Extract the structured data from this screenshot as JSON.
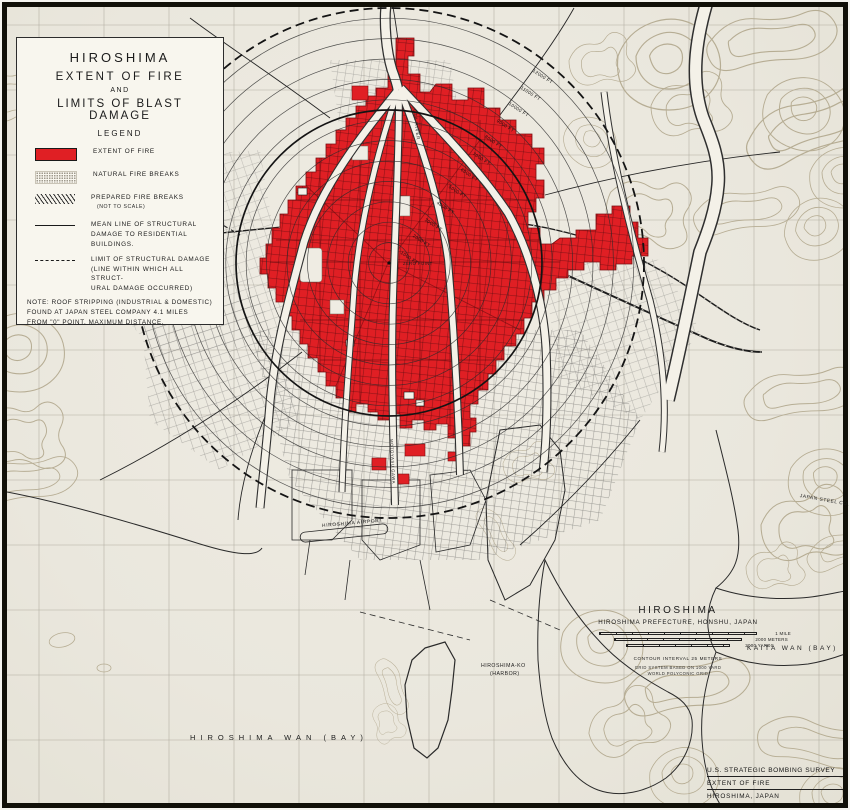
{
  "map_title": "Hiroshima — Extent of Fire and Limits of Blast Damage",
  "colors": {
    "fire_red": "#e01f24",
    "paper": "#eae7dd",
    "ink": "#1d1d1d",
    "contour_tan": "#b4aa90"
  },
  "legend": {
    "title_line1": "HIROSHIMA",
    "title_line2": "EXTENT OF FIRE",
    "title_line3": "AND",
    "title_line4": "LIMITS OF BLAST DAMAGE",
    "heading": "LEGEND",
    "items": [
      {
        "label": "EXTENT OF FIRE"
      },
      {
        "label": "NATURAL FIRE BREAKS"
      },
      {
        "label": "PREPARED FIRE BREAKS",
        "note": "(NOT TO SCALE)"
      },
      {
        "line1": "MEAN LINE OF STRUCTURAL",
        "line2": "DAMAGE TO RESIDENTIAL BUILDINGS."
      },
      {
        "line1": "LIMIT OF STRUCTURAL DAMAGE",
        "line2": "(LINE WITHIN WHICH ALL STRUCT-",
        "line3": "URAL DAMAGE OCCURRED)"
      }
    ],
    "note_line1": "NOTE: ROOF STRIPPING (INDUSTRIAL & DOMESTIC)",
    "note_line2": "FOUND AT JAPAN STEEL COMPANY 4.1 MILES",
    "note_line3": "FROM \"0\" POINT. MAXIMUM DISTANCE."
  },
  "rings": {
    "zero_label": "ZERO POINT",
    "labels": [
      "1000 FT",
      "2000 FT",
      "3000 FT",
      "4000 FT",
      "5000 FT",
      "6000 FT",
      "7000 FT",
      "8000 FT",
      "9000 FT",
      "10000 FT",
      "11000 FT",
      "12000 FT"
    ]
  },
  "labels": {
    "hiroshima_wan": "HIROSHIMA WAN (BAY)",
    "kaita_wan": "KAITA WAN (BAY)",
    "harbor_line1": "HIROSHIMA-KO",
    "harbor_line2": "(HARBOR)",
    "airport": "HIROSHIMA AIRPORT",
    "japan_steel": "JAPAN STEEL CO.",
    "ota_river": "OTA RIVER",
    "motoyasu_gawa": "MOTOYASU GAWA"
  },
  "title_block": {
    "title": "HIROSHIMA",
    "subtitle": "HIROSHIMA PREFECTURE, HONSHU, JAPAN",
    "scale_mile": "1 MILE",
    "scale_meters": "2000 METERS",
    "scale_yards": "2000 YARDS",
    "contour_note": "CONTOUR INTERVAL 25 METERS",
    "grid_note_line1": "GRID SYSTEM BASED ON 1000 YARD",
    "grid_note_line2": "WORLD POLYCONIC GRID"
  },
  "credit": {
    "line1": "U.S. STRATEGIC BOMBING SURVEY",
    "line2": "EXTENT OF FIRE",
    "line3": "HIROSHIMA, JAPAN"
  }
}
